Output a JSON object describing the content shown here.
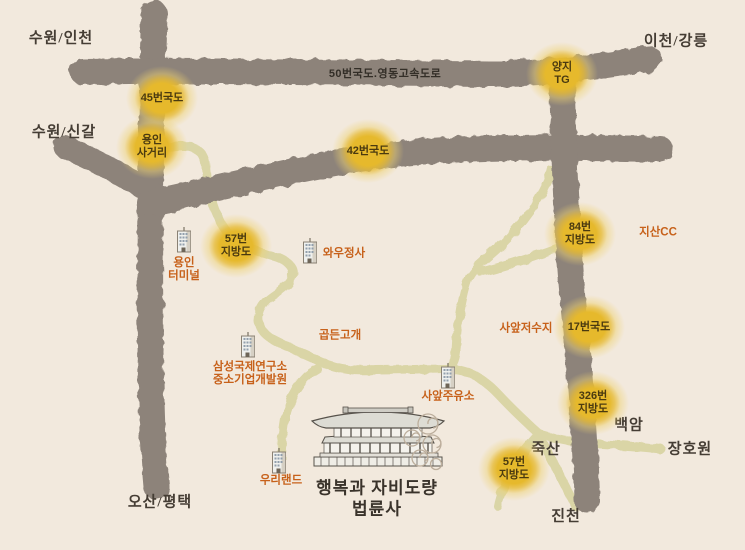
{
  "colors": {
    "background": "#f2e9dd",
    "road-major": "#8d837a",
    "road-minor": "#dad5a6",
    "badge-yellow": "#e6b92c",
    "accent-orange": "#c7611a",
    "text-dark": "#453d34"
  },
  "region_labels": [
    {
      "id": "suwon-incheon",
      "text": "수원/인천"
    },
    {
      "id": "icheon-gangneung",
      "text": "이천/강릉"
    },
    {
      "id": "suwon-singal",
      "text": "수원/신갈"
    },
    {
      "id": "osan-pyeongtaek",
      "text": "오산/평택"
    },
    {
      "id": "baegam",
      "text": "백암"
    },
    {
      "id": "janghowon",
      "text": "장호원"
    },
    {
      "id": "juksan",
      "text": "죽산"
    },
    {
      "id": "jincheon",
      "text": "진천"
    }
  ],
  "road_labels": [
    {
      "id": "route50-expressway",
      "text": "50번국도.영동고속도로"
    }
  ],
  "badges": [
    {
      "id": "route45",
      "line1": "45번국도",
      "line2": ""
    },
    {
      "id": "yongin-sageori",
      "line1": "용인",
      "line2": "사거리"
    },
    {
      "id": "route42",
      "line1": "42번국도",
      "line2": ""
    },
    {
      "id": "yangji-tg",
      "line1": "양지",
      "line2": "TG"
    },
    {
      "id": "local57-north",
      "line1": "57번",
      "line2": "지방도"
    },
    {
      "id": "local84",
      "line1": "84번",
      "line2": "지방도"
    },
    {
      "id": "route17",
      "line1": "17번국도",
      "line2": ""
    },
    {
      "id": "local326",
      "line1": "326번",
      "line2": "지방도"
    },
    {
      "id": "local57-south",
      "line1": "57번",
      "line2": "지방도"
    }
  ],
  "places": [
    {
      "id": "yongin-terminal",
      "line1": "용인",
      "line2": "터미널"
    },
    {
      "id": "wawoojeongsa",
      "line1": "와우정사",
      "line2": ""
    },
    {
      "id": "jisan-cc",
      "line1": "지산CC",
      "line2": ""
    },
    {
      "id": "gopdeun-pass",
      "line1": "곱든고개",
      "line2": ""
    },
    {
      "id": "saap-reservoir",
      "line1": "사앞저수지",
      "line2": ""
    },
    {
      "id": "samsung-institute",
      "line1": "삼성국제연구소",
      "line2": "중소기업개발원"
    },
    {
      "id": "saap-gas-station",
      "line1": "사앞주유소",
      "line2": ""
    },
    {
      "id": "wooriland",
      "line1": "우리랜드",
      "line2": ""
    }
  ],
  "temple": {
    "tagline": "행복과 자비도량",
    "name": "법륜사"
  }
}
